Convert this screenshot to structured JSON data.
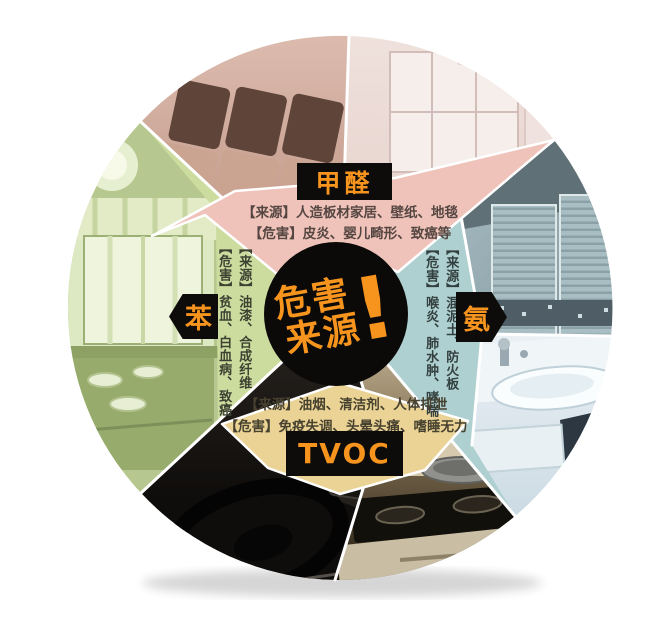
{
  "page": {
    "background": "#ffffff",
    "description": "圆形室内空气污染危害来源信息图"
  },
  "center_badge": {
    "line1": "危害",
    "line2": "来源",
    "exclaim": "!"
  },
  "sections": {
    "formaldehyde": {
      "label": "甲醛",
      "source": "【来源】人造板材家居、壁纸、地毯",
      "harm": "【危害】皮炎、婴儿畸形、致癌等"
    },
    "benzene": {
      "label": "苯",
      "source": "【来源】油漆、合成纤维",
      "harm": "【危害】贫血、白血病、致癌"
    },
    "ammonia": {
      "label": "氨",
      "source": "【来源】混泥土、防火板",
      "harm": "【危害】喉炎、肺水肿、哮喘"
    },
    "tvoc": {
      "label": "TVOC",
      "source": "【来源】油烟、清洁剂、人体排泄",
      "harm": "【危害】免疫失调、头晕头痛、嗜睡无力"
    }
  },
  "photos": {
    "living_room": "sofa-living-room-photo",
    "kids_room": "kids-room-cabinet-photo",
    "wardrobe": "wardrobe-closet-photo",
    "bathroom": "bathroom-sink-photo",
    "kitchen": "kitchen-stove-photo",
    "car": "car-interior-photo",
    "window_room": "green-window-room-photo"
  },
  "colors": {
    "accent_orange": "#f6941e",
    "label_bg": "#0d0c0a",
    "band_pink": "#efc3ba",
    "wedge_green": "#ccdc9e",
    "wedge_teal": "#aed0d0",
    "band_tan": "#ead395",
    "text_dark": "#4a423e"
  }
}
